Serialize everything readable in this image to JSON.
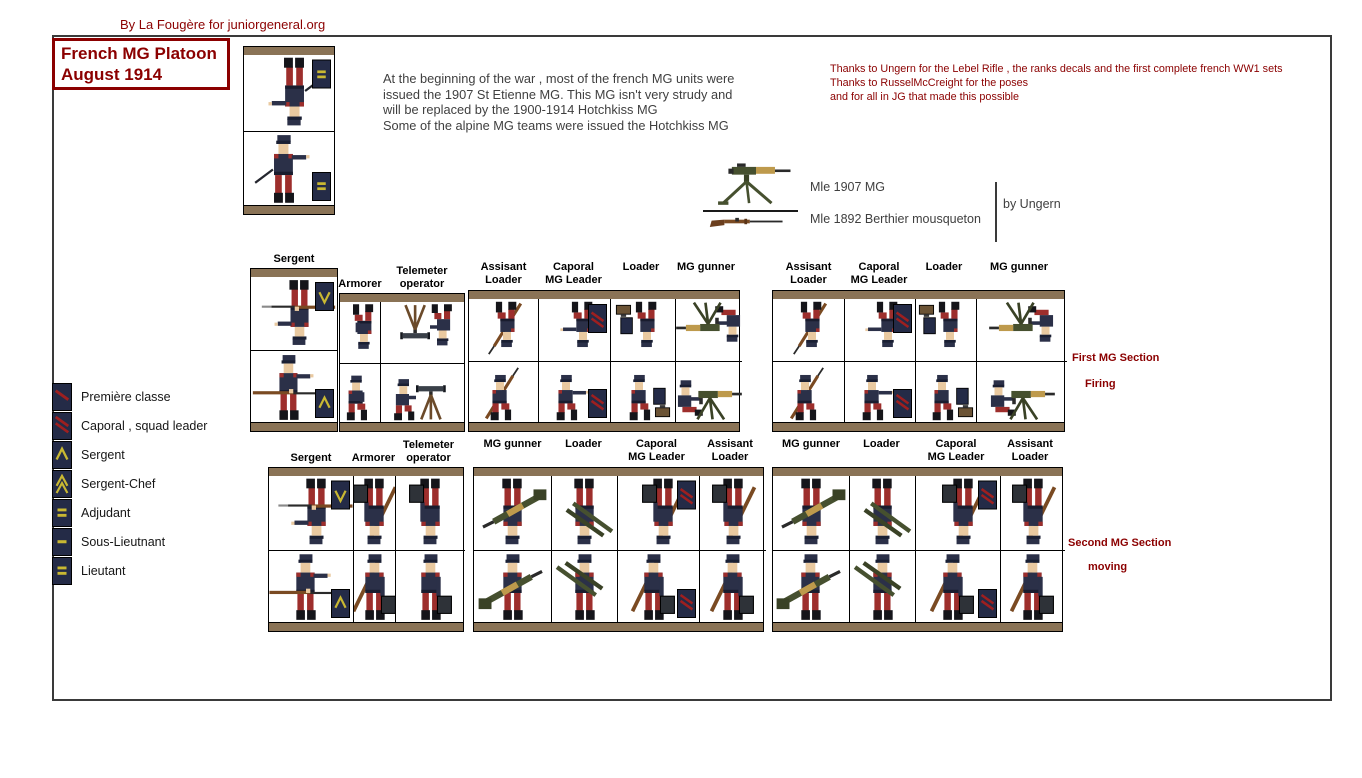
{
  "credit": "By La Fougère for juniorgeneral.org",
  "title": {
    "line1": "French MG Platoon",
    "line2": "August 1914"
  },
  "intro_lines": [
    "At the beginning of the war , most of the french MG units were",
    "issued the 1907 St Etienne MG. This MG isn't very strudy and",
    "will be replaced by the 1900-1914 Hotchkiss MG",
    "Some of the alpine MG teams were issued the Hotchkiss MG"
  ],
  "thanks_lines": [
    "Thanks to Ungern for the Lebel Rifle , the ranks decals and the first complete french WW1 sets",
    "Thanks to RusselMcCreight for the poses",
    "and for all in JG that made this possible"
  ],
  "weapons": {
    "mg_label": "Mle 1907 MG",
    "carbine_label": "Mle 1892 Berthier mousqueton",
    "credit": "by Ungern",
    "mg_icon": "mle-1907-mg-icon",
    "carbine_icon": "mle-1892-carbine-icon"
  },
  "legend": {
    "items": [
      {
        "label": "Première classe",
        "insignia": "stripe1"
      },
      {
        "label": "Caporal , squad leader",
        "insignia": "stripe2"
      },
      {
        "label": "Sergent",
        "insignia": "chevron1"
      },
      {
        "label": "Sergent-Chef",
        "insignia": "chevron2"
      },
      {
        "label": "Adjudant",
        "insignia": "bar2"
      },
      {
        "label": "Sous-Lieutnant",
        "insignia": "bar1"
      },
      {
        "label": "Lieutant",
        "insignia": "bar2"
      }
    ]
  },
  "annotations": {
    "first_line1": "First MG Section",
    "first_line2": "Firing",
    "second_line1": "Second MG Section",
    "second_line2": "moving"
  },
  "figure_groups": [
    {
      "id": "officer-panel",
      "left": 243,
      "top": 46,
      "height": 169,
      "label_align": "bottom",
      "cells": [
        {
          "label": "",
          "width": 90,
          "figure": "officer",
          "patch": "bar2",
          "role": "lieutenant"
        }
      ]
    },
    {
      "id": "hq-first",
      "left": 250,
      "top": 268,
      "height": 164,
      "label_align": "bottom",
      "cells": [
        {
          "label": "Sergent",
          "width": 86,
          "figure": "sergent-rifle",
          "patch": "chevron1",
          "role": "sergent"
        }
      ]
    },
    {
      "id": "hq-first-b",
      "left": 339,
      "top": 293,
      "height": 139,
      "label_align": "bottom",
      "cells": [
        {
          "label": "Armorer",
          "width": 40,
          "figure": "kneel",
          "patch": null,
          "role": "armorer"
        },
        {
          "label": "Telemeter\noperator",
          "width": 84,
          "figure": "telemeter",
          "patch": null,
          "role": "telemeter-operator"
        }
      ]
    },
    {
      "id": "squad-first-a",
      "left": 468,
      "top": 290,
      "height": 142,
      "label_align": "top",
      "cells": [
        {
          "label": "Assisant\nLoader",
          "width": 69,
          "figure": "kneel-rifle",
          "patch": null,
          "role": "assistant-loader"
        },
        {
          "label": "Caporal\nMG Leader",
          "width": 71,
          "figure": "kneel-point",
          "patch": "stripe2",
          "role": "caporal-mg-leader"
        },
        {
          "label": "Loader",
          "width": 64,
          "figure": "kneel-ammo",
          "patch": null,
          "role": "loader"
        },
        {
          "label": "MG gunner",
          "width": 66,
          "figure": "mg-seated",
          "patch": null,
          "role": "mg-gunner"
        }
      ]
    },
    {
      "id": "squad-first-b",
      "left": 772,
      "top": 290,
      "height": 142,
      "label_align": "top",
      "cells": [
        {
          "label": "Assisant\nLoader",
          "width": 71,
          "figure": "kneel-rifle",
          "patch": null,
          "role": "assistant-loader"
        },
        {
          "label": "Caporal\nMG Leader",
          "width": 70,
          "figure": "kneel-point",
          "patch": "stripe2",
          "role": "caporal-mg-leader"
        },
        {
          "label": "Loader",
          "width": 60,
          "figure": "kneel-ammo",
          "patch": null,
          "role": "loader"
        },
        {
          "label": "MG gunner",
          "width": 90,
          "figure": "mg-seated",
          "patch": null,
          "role": "mg-gunner"
        }
      ]
    },
    {
      "id": "hq-second",
      "left": 268,
      "top": 467,
      "height": 165,
      "label_align": "bottom",
      "cells": [
        {
          "label": "Sergent",
          "width": 84,
          "figure": "sergent-rifle",
          "patch": "chevron1",
          "role": "sergent"
        },
        {
          "label": "Armorer",
          "width": 41,
          "figure": "walk-rifle-case",
          "patch": null,
          "role": "armorer"
        },
        {
          "label": "Telemeter\noperator",
          "width": 69,
          "figure": "walk-case",
          "patch": null,
          "role": "telemeter-operator"
        }
      ]
    },
    {
      "id": "squad-second-a",
      "left": 473,
      "top": 467,
      "height": 165,
      "label_align": "top",
      "cells": [
        {
          "label": "MG gunner",
          "width": 77,
          "figure": "walk-mg",
          "patch": null,
          "role": "mg-gunner"
        },
        {
          "label": "Loader",
          "width": 65,
          "figure": "walk-tripod",
          "patch": null,
          "role": "loader"
        },
        {
          "label": "Caporal\nMG Leader",
          "width": 81,
          "figure": "walk-rifle-case",
          "patch": "stripe2",
          "role": "caporal-mg-leader"
        },
        {
          "label": "Assisant\nLoader",
          "width": 66,
          "figure": "walk-rifle-case",
          "patch": null,
          "role": "assistant-loader"
        }
      ]
    },
    {
      "id": "squad-second-b",
      "left": 772,
      "top": 467,
      "height": 165,
      "label_align": "top",
      "cells": [
        {
          "label": "MG gunner",
          "width": 76,
          "figure": "walk-mg",
          "patch": null,
          "role": "mg-gunner"
        },
        {
          "label": "Loader",
          "width": 65,
          "figure": "walk-tripod",
          "patch": null,
          "role": "loader"
        },
        {
          "label": "Caporal\nMG Leader",
          "width": 84,
          "figure": "walk-rifle-case",
          "patch": "stripe2",
          "role": "caporal-mg-leader"
        },
        {
          "label": "Assisant\nLoader",
          "width": 64,
          "figure": "walk-rifle-case",
          "patch": null,
          "role": "assistant-loader"
        }
      ]
    }
  ],
  "colors": {
    "accent_red": "#8B0000",
    "text_gray": "#3F3F3F",
    "frame_gray": "#3A3A3A",
    "bar_tan": "#8A7356",
    "coat_navy": "#2B3048",
    "trouser_red": "#9D2E2C",
    "patch_navy": "#242B47",
    "insignia_yellow": "#C9B832",
    "stripe_red": "#9E1F1F",
    "equipment_olive": "#46502F",
    "wood_brown": "#7A4A22",
    "mg_brass": "#BE9A4C"
  }
}
